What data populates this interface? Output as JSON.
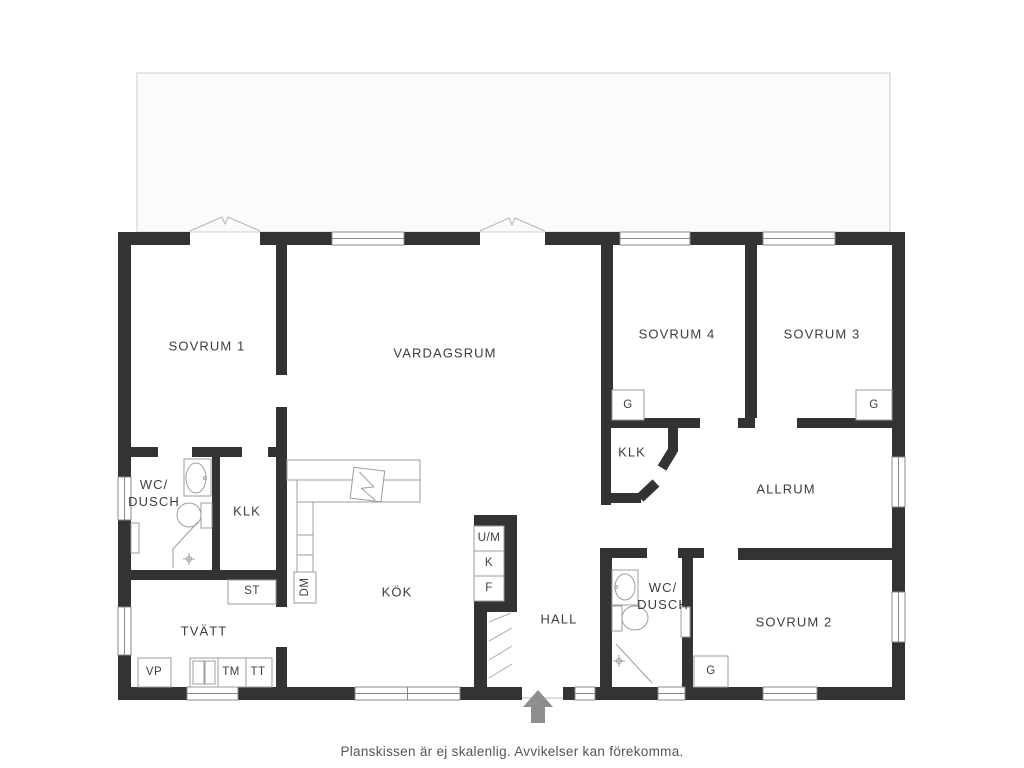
{
  "caption": "Planskissen är ej skalenlig. Avvikelser kan förekomma.",
  "rooms": {
    "sovrum1": "SOVRUM 1",
    "vardagsrum": "VARDAGSRUM",
    "sovrum4": "SOVRUM 4",
    "sovrum3": "SOVRUM 3",
    "sovrum2": "SOVRUM 2",
    "allrum": "ALLRUM",
    "kok": "KÖK",
    "hall": "HALL",
    "tvatt": "TVÄTT",
    "klk_left": "KLK",
    "klk_right": "KLK",
    "wc_dusch_left": {
      "line1": "WC/",
      "line2": "DUSCH"
    },
    "wc_dusch_right": {
      "line1": "WC/",
      "line2": "DUSCH"
    }
  },
  "labels": {
    "st": "ST",
    "dm": "DM",
    "vp": "VP",
    "tm": "TM",
    "tt": "TT",
    "um": "U/M",
    "k": "K",
    "f": "F",
    "g_sovrum4": "G",
    "g_sovrum3": "G",
    "g_sovrum2": "G"
  },
  "colors": {
    "wall": "#333333",
    "text": "#3d3d3d",
    "fixture": "#9e9e9e",
    "arrow": "#8e8e8e",
    "deck": "#cccccc",
    "caption": "#555555",
    "winline": "#8a8a8a"
  }
}
